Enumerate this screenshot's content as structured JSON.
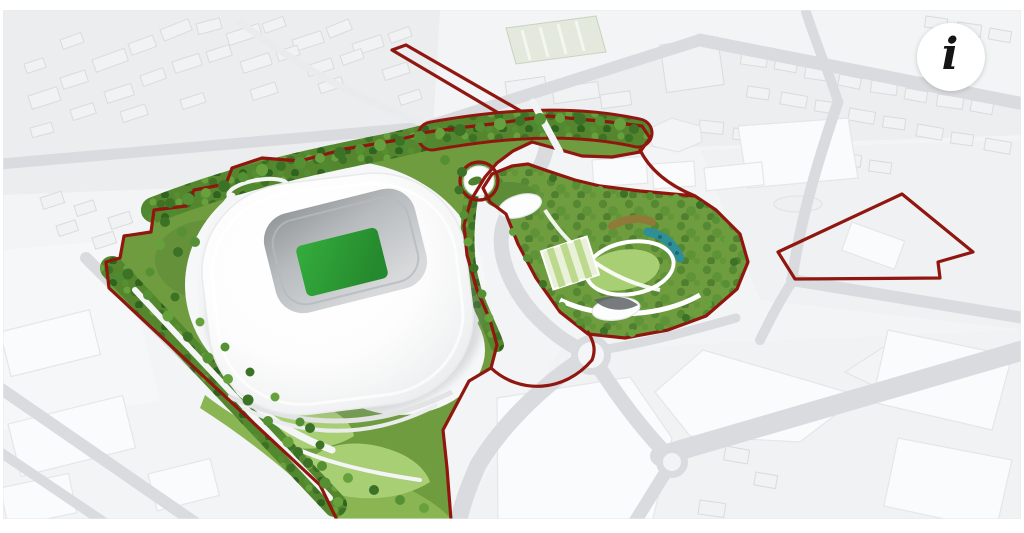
{
  "info_button": {
    "glyph": "i"
  },
  "colors": {
    "page_background": "#ffffff",
    "ground": "#f3f4f5",
    "road_grey": "#d9dbde",
    "block_fill": "#f0f2f3",
    "block_edge": "#d9dbdd",
    "boundary_red": "#8f1710",
    "park_green": "#6f9c3f",
    "belt_green": "#55862e",
    "lawn_green": "#a9cf74",
    "lawn_mid": "#8ab553",
    "pitch_green": "#2fa238",
    "pitch_shade": "#27872e",
    "teal": "#2e8f96",
    "earth_brown": "#8f7a3a"
  }
}
